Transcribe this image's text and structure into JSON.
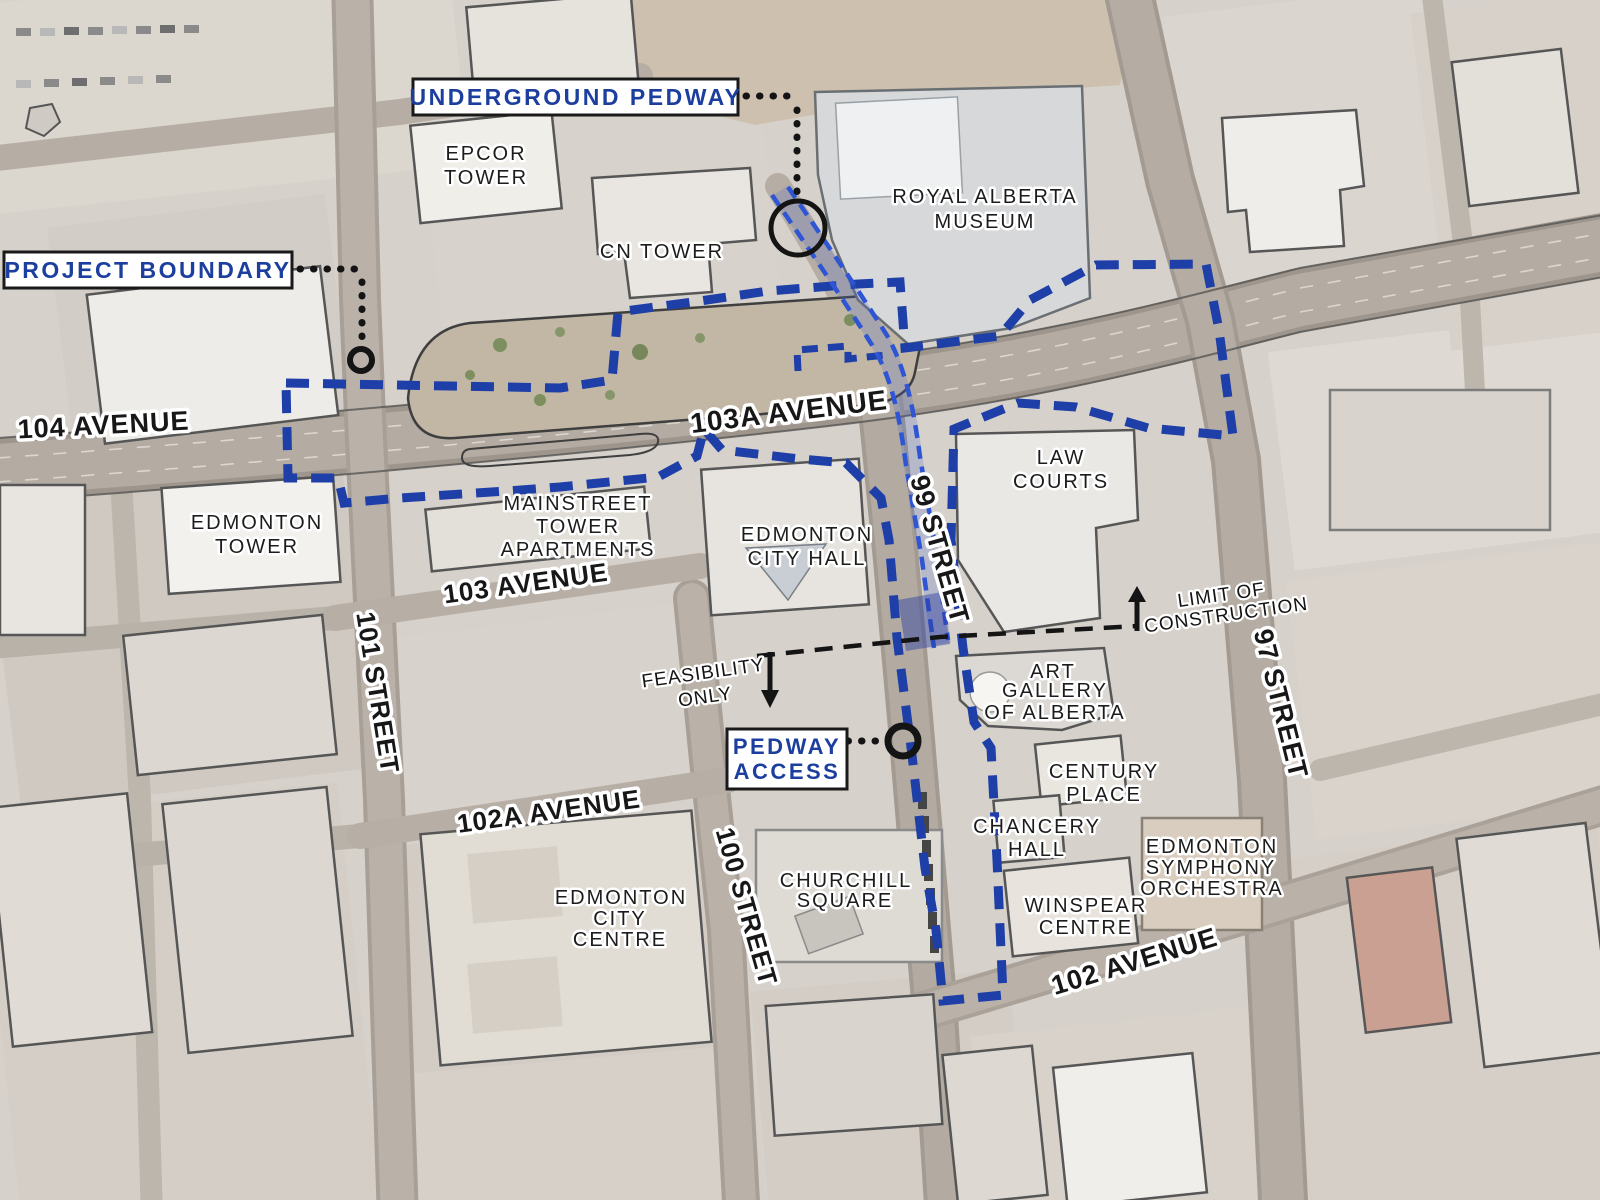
{
  "callouts": {
    "underground_pedway": "UNDERGROUND PEDWAY",
    "project_boundary": "PROJECT BOUNDARY",
    "pedway_access": [
      "PEDWAY",
      "ACCESS"
    ]
  },
  "street_labels": {
    "avenue_104": "104 AVENUE",
    "avenue_103a": "103A AVENUE",
    "avenue_103": "103 AVENUE",
    "avenue_102a": "102A AVENUE",
    "avenue_102": "102 AVENUE",
    "street_101": "101 STREET",
    "street_100": "100 STREET",
    "street_99": "99 STREET",
    "street_97": "97 STREET"
  },
  "building_labels": {
    "epcor_tower": [
      "EPCOR",
      "TOWER"
    ],
    "cn_tower": [
      "CN TOWER"
    ],
    "royal_alberta_museum": [
      "ROYAL ALBERTA",
      "MUSEUM"
    ],
    "edmonton_tower": [
      "EDMONTON",
      "TOWER"
    ],
    "mainstreet_tower_apartments": [
      "MAINSTREET",
      "TOWER",
      "APARTMENTS"
    ],
    "edmonton_city_hall": [
      "EDMONTON",
      "CITY HALL"
    ],
    "law_courts": [
      "LAW",
      "COURTS"
    ],
    "art_gallery_of_alberta": [
      "ART",
      "GALLERY",
      "OF ALBERTA"
    ],
    "century_place": [
      "CENTURY",
      "PLACE"
    ],
    "chancery_hall": [
      "CHANCERY",
      "HALL"
    ],
    "edmonton_symphony_orchestra": [
      "EDMONTON",
      "SYMPHONY",
      "ORCHESTRA"
    ],
    "winspear_centre": [
      "WINSPEAR",
      "CENTRE"
    ],
    "churchill_square": [
      "CHURCHILL",
      "SQUARE"
    ],
    "edmonton_city_centre": [
      "EDMONTON",
      "CITY",
      "CENTRE"
    ]
  },
  "annotations": {
    "limit_of_construction": [
      "LIMIT OF",
      "CONSTRUCTION"
    ],
    "feasibility_only": [
      "FEASIBILITY",
      "ONLY"
    ]
  },
  "legend_colors": {
    "project_boundary_blue": "#1e3ea8",
    "pedway_blue": "#2e55d4",
    "callout_text_blue": "#1c3f9f",
    "annotation_black": "#141414"
  }
}
